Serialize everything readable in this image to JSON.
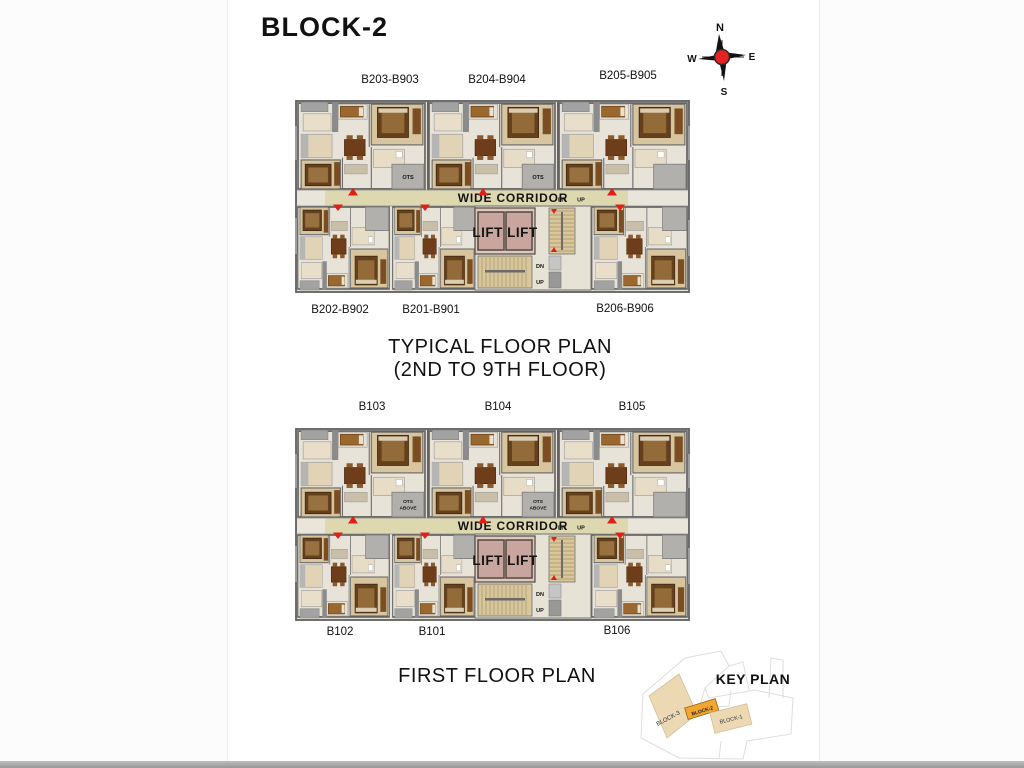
{
  "page": {
    "title": "BLOCK-2"
  },
  "compass": {
    "north": "N",
    "east": "E",
    "south": "S",
    "west": "W"
  },
  "plans": [
    {
      "name": "typical-floor-plan",
      "title_lines": [
        "TYPICAL FLOOR PLAN",
        "(2ND TO 9TH FLOOR)"
      ],
      "top_labels": [
        "B203-B903",
        "B204-B904",
        "B205-B905"
      ],
      "bottom_labels": [
        "B202-B902",
        "B201-B901",
        "B206-B906"
      ],
      "corridor_label": "WIDE CORRIDOR",
      "lift_label": "LIFT LIFT",
      "stair_down_label": "DN",
      "stair_up_label": "UP",
      "ots_label": "OTS"
    },
    {
      "name": "first-floor-plan",
      "title_lines": [
        "FIRST FLOOR PLAN"
      ],
      "top_labels": [
        "B103",
        "B104",
        "B105"
      ],
      "bottom_labels": [
        "B102",
        "B101",
        "B106"
      ],
      "corridor_label": "WIDE CORRIDOR",
      "lift_label": "LIFT LIFT",
      "stair_down_label": "DN",
      "stair_up_label": "UP",
      "ots_label": "OTS ABOVE"
    }
  ],
  "key_plan": {
    "title": "KEY PLAN",
    "blocks": [
      {
        "label": "BLOCK-3",
        "highlighted": false
      },
      {
        "label": "BLOCK-2",
        "highlighted": true
      },
      {
        "label": "BLOCK-1",
        "highlighted": false
      }
    ]
  },
  "colors": {
    "corridor": "#ddd8b0",
    "lift_room": "#c8a59e",
    "stair": "#d9c79c",
    "floor": "#e8e3d8",
    "bedroom_tan": "#d7c5a0",
    "wall_gray": "#636363",
    "ots_gray": "#b2b0ac",
    "entry_red": "#e02018",
    "keyplan_block": "#ecd9b4",
    "keyplan_highlight": "#f4a52f",
    "bed_brown": "#65401d",
    "furniture_brown": "#6e3d1a"
  }
}
